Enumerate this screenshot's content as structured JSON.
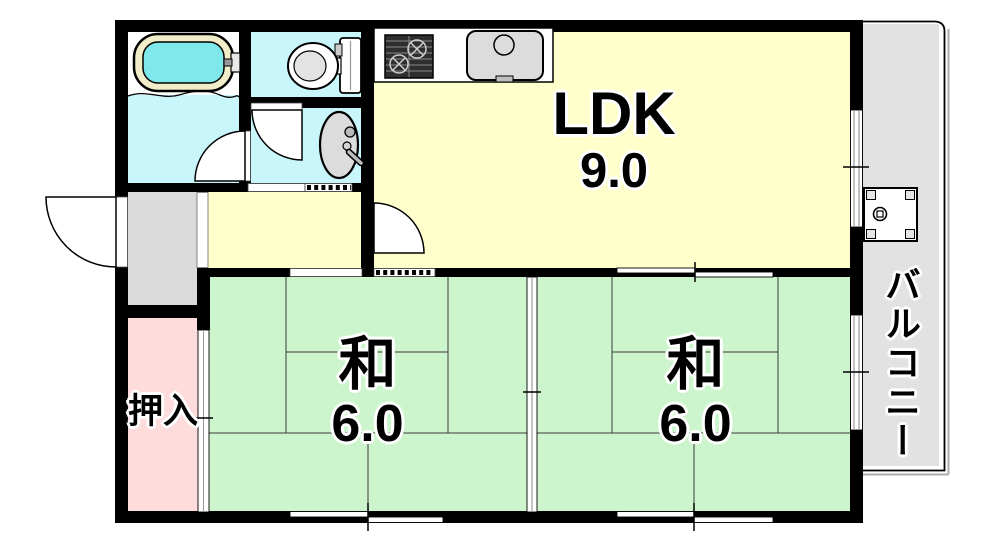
{
  "plan": {
    "type": "apartment-floor-plan",
    "rooms": {
      "ldk": {
        "label": "LDK",
        "area": "9.0"
      },
      "japanese_room_left": {
        "label": "和",
        "area": "6.0"
      },
      "japanese_room_right": {
        "label": "和",
        "area": "6.0"
      },
      "closet": {
        "label": "押入"
      },
      "balcony": {
        "label": "バルコニー"
      }
    },
    "fixtures": [
      "bathtub",
      "toilet",
      "washbasin",
      "gas-stove",
      "kitchen-sink",
      "washing-machine-pan"
    ],
    "colors": {
      "wall": "#000000",
      "ldk_fill": "#FFFFCB",
      "tatami_fill": "#CDF5CD",
      "closet_fill": "#FFDCDC",
      "wet_fill": "#C9F6FB",
      "genkan_fill": "#DBDBDB",
      "balcony_fill": "#E2E2E2",
      "bath_water": "#7FE8EA",
      "tub_rim": "#F0EDC8"
    }
  }
}
